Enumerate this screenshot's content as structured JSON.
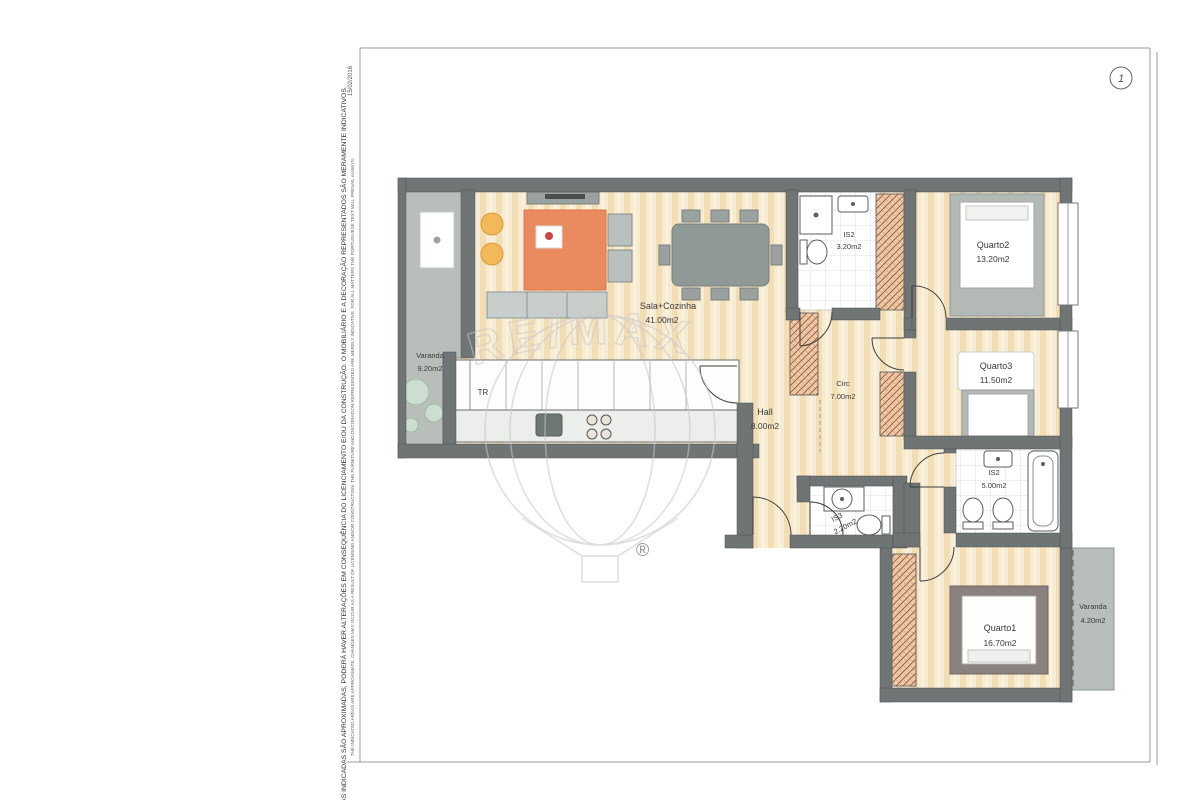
{
  "page": {
    "sheet_number": "1",
    "date_stamp": "15/02/2016",
    "disclaimer_pt": "AS ÁREAS INDICADAS SÃO APROXIMADAS, PODERÁ HAVER ALTERAÇÕES EM CONSEQUÊNCIA DO LICENCIAMENTO E/OU DA CONSTRUÇÃO. O MOBILIÁRIO E A DECORAÇÃO REPRESENTADOS SÃO MERAMENTE INDICATIVOS.",
    "disclaimer_en": "THE INDICATED AREAS ARE APPROXIMATE, CHANGES MAY OCCUR AS A RESULT OF LICENSING AND/OR CONSTRUCTION. THE FURNITURE AND DECORATION REPRESENTED ARE MERELY INDICATIVE. FOR ALL MATTERS THE PORTUGUESE TEXT WILL PREVAIL ALWAYS."
  },
  "watermark": {
    "brand": "RE/MAX",
    "registered_symbol": "®"
  },
  "rooms": {
    "varanda_left": {
      "label": "Varanda",
      "area": "9.20m2"
    },
    "sala_cozinha": {
      "label": "Sala+Cozinha",
      "area": "41.00m2"
    },
    "is_top": {
      "label": "IS2",
      "area": "3.20m2"
    },
    "quarto2": {
      "label": "Quarto2",
      "area": "13.20m2"
    },
    "circ": {
      "label": "Circ",
      "area": "7.00m2"
    },
    "quarto3": {
      "label": "Quarto3",
      "area": "11.50m2"
    },
    "hall": {
      "label": "Hall",
      "area": "8.00m2"
    },
    "is3": {
      "label": "IS3",
      "area": "2.20m2"
    },
    "is_right": {
      "label": "IS2",
      "area": "5.00m2"
    },
    "quarto1": {
      "label": "Quarto1",
      "area": "16.70m2"
    },
    "varanda_right": {
      "label": "Varanda",
      "area": "4.20m2"
    },
    "kitchen_unit": {
      "label": "TR"
    }
  },
  "colors": {
    "wall": "#6e7574",
    "wood_floor": "#f7ebd2",
    "balcony_gray": "#b8bfba",
    "wardrobe_hatch": "#f2c6a2",
    "rug_orange": "#e98a5f",
    "pouf_yellow": "#f2b95b",
    "watermark_gray": "#c6c6c6"
  }
}
